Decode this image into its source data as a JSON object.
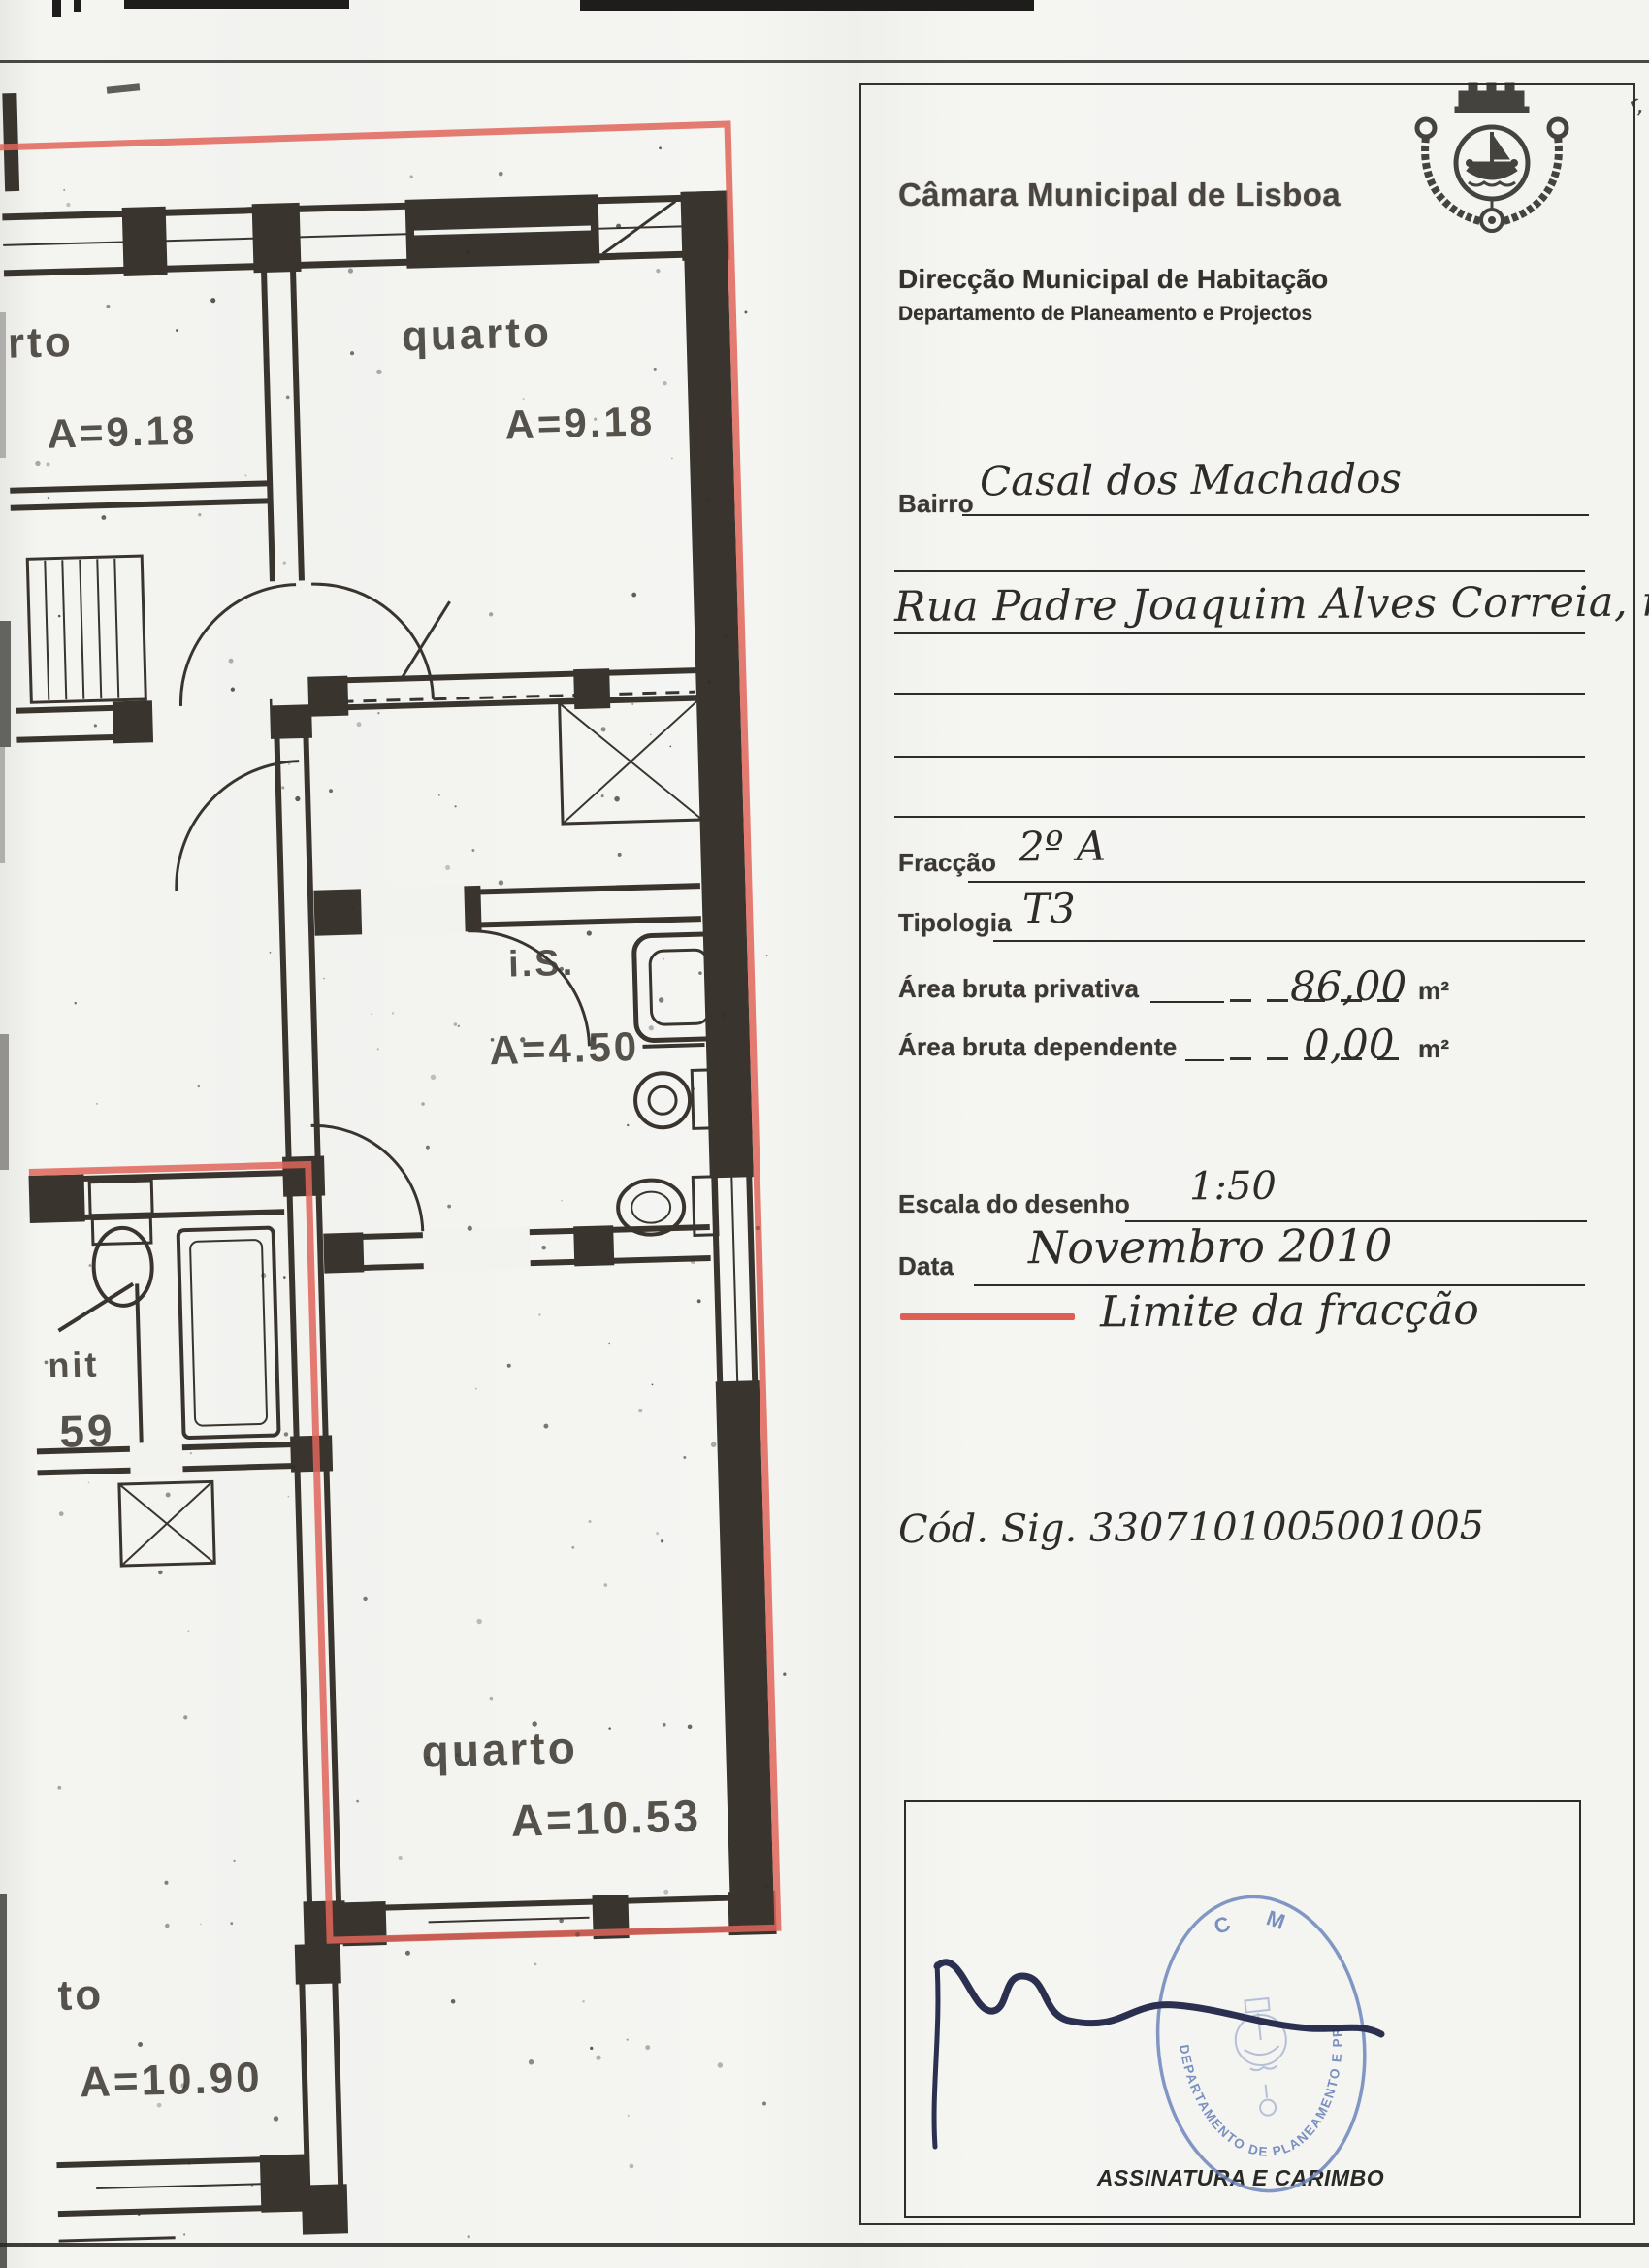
{
  "header": {
    "org": "Câmara Municipal de Lisboa",
    "dept": "Direcção Municipal de Habitação",
    "sub": "Departamento de Planeamento e Projectos"
  },
  "fields": {
    "bairro_label": "Bairro",
    "bairro_value": "Casal dos Machados",
    "address_value": "Rua Padre Joaquim Alves Correia, nº 6",
    "fraccao_label": "Fracção",
    "fraccao_value": "2º A",
    "tipologia_label": "Tipologia",
    "tipologia_value": "T3",
    "area_privativa_label": "Área bruta privativa",
    "area_privativa_value": "86,00",
    "area_dependente_label": "Área bruta dependente",
    "area_dependente_value": "0,00",
    "unit": "m²",
    "escala_label": "Escala do desenho",
    "escala_value": "1:50",
    "data_label": "Data",
    "data_value": "Novembro 2010"
  },
  "legend": {
    "label": "Limite da fracção",
    "line_color": "#dd6056"
  },
  "cod_sig": "Cód. Sig. 3307101005001005",
  "signature_box": {
    "label": "ASSINATURA E CARIMBO",
    "stamp_top": "C M L",
    "stamp_ring": "DEPARTAMENTO DE PLANEAMENTO E PROJECTOS",
    "stamp_color": "#647fb8"
  },
  "plan": {
    "rooms": [
      {
        "label": "rto",
        "area": "A=9.18"
      },
      {
        "label": "quarto",
        "area": "A=9.18"
      },
      {
        "label": "i.S.",
        "area": "A=4.50"
      },
      {
        "label": "quarto",
        "area": "A=10.53"
      },
      {
        "label": "to",
        "area": "A=10.90"
      },
      {
        "label": "nit",
        "area": "59"
      }
    ]
  }
}
